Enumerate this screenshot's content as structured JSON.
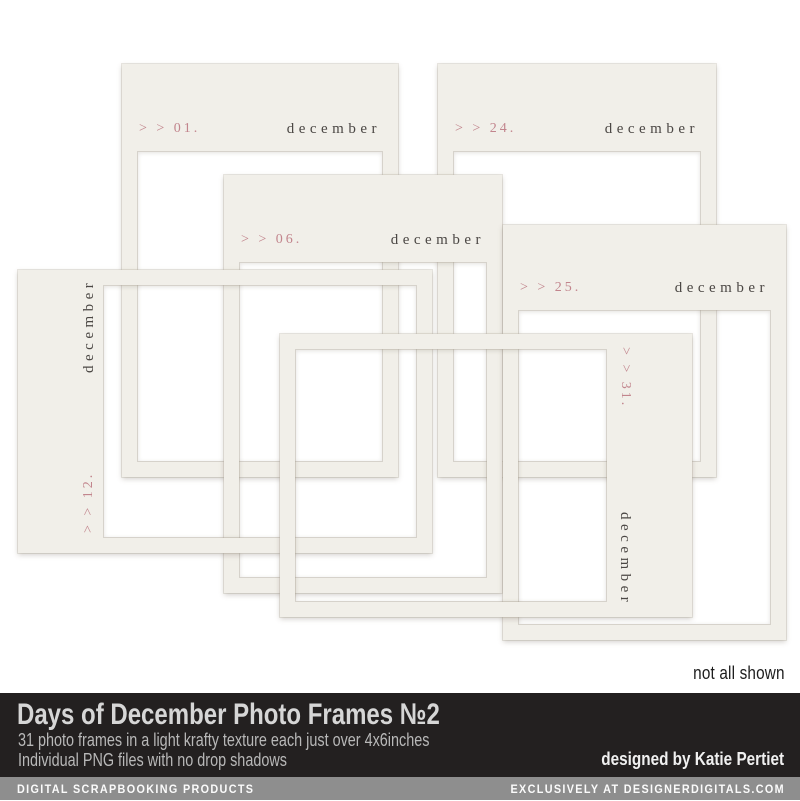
{
  "product_preview": {
    "note": "not all shown",
    "frames": [
      {
        "number": "> > 01.",
        "month": "december",
        "orientation": "portrait"
      },
      {
        "number": "> > 24.",
        "month": "december",
        "orientation": "portrait"
      },
      {
        "number": "> > 06.",
        "month": "december",
        "orientation": "portrait"
      },
      {
        "number": "> > 25.",
        "month": "december",
        "orientation": "portrait"
      },
      {
        "number": "> > 12.",
        "month": "december",
        "orientation": "landscape-rotated-ccw"
      },
      {
        "number": "> > 31.",
        "month": "december",
        "orientation": "landscape-rotated-cw"
      }
    ]
  },
  "footer": {
    "title": "Days of December Photo Frames №2",
    "subtitle_line1": "31 photo frames  in a light krafty texture each just over 4x6inches",
    "subtitle_line2": "Individual PNG files with no drop shadows",
    "designed_by": "designed by Katie Pertiet",
    "bottom_bar_left": "DIGITAL SCRAPBOOKING PRODUCTS",
    "bottom_bar_right": "EXCLUSIVELY AT DESIGNERDIGITALS.COM"
  },
  "colors": {
    "frame_cream": "#f1efe9",
    "day_number_pink": "#c2858d",
    "month_ink": "#4b4744",
    "footer_band_black": "#232020",
    "footer_band_gray": "#8e8e8e",
    "page_background": "#ffffff"
  }
}
